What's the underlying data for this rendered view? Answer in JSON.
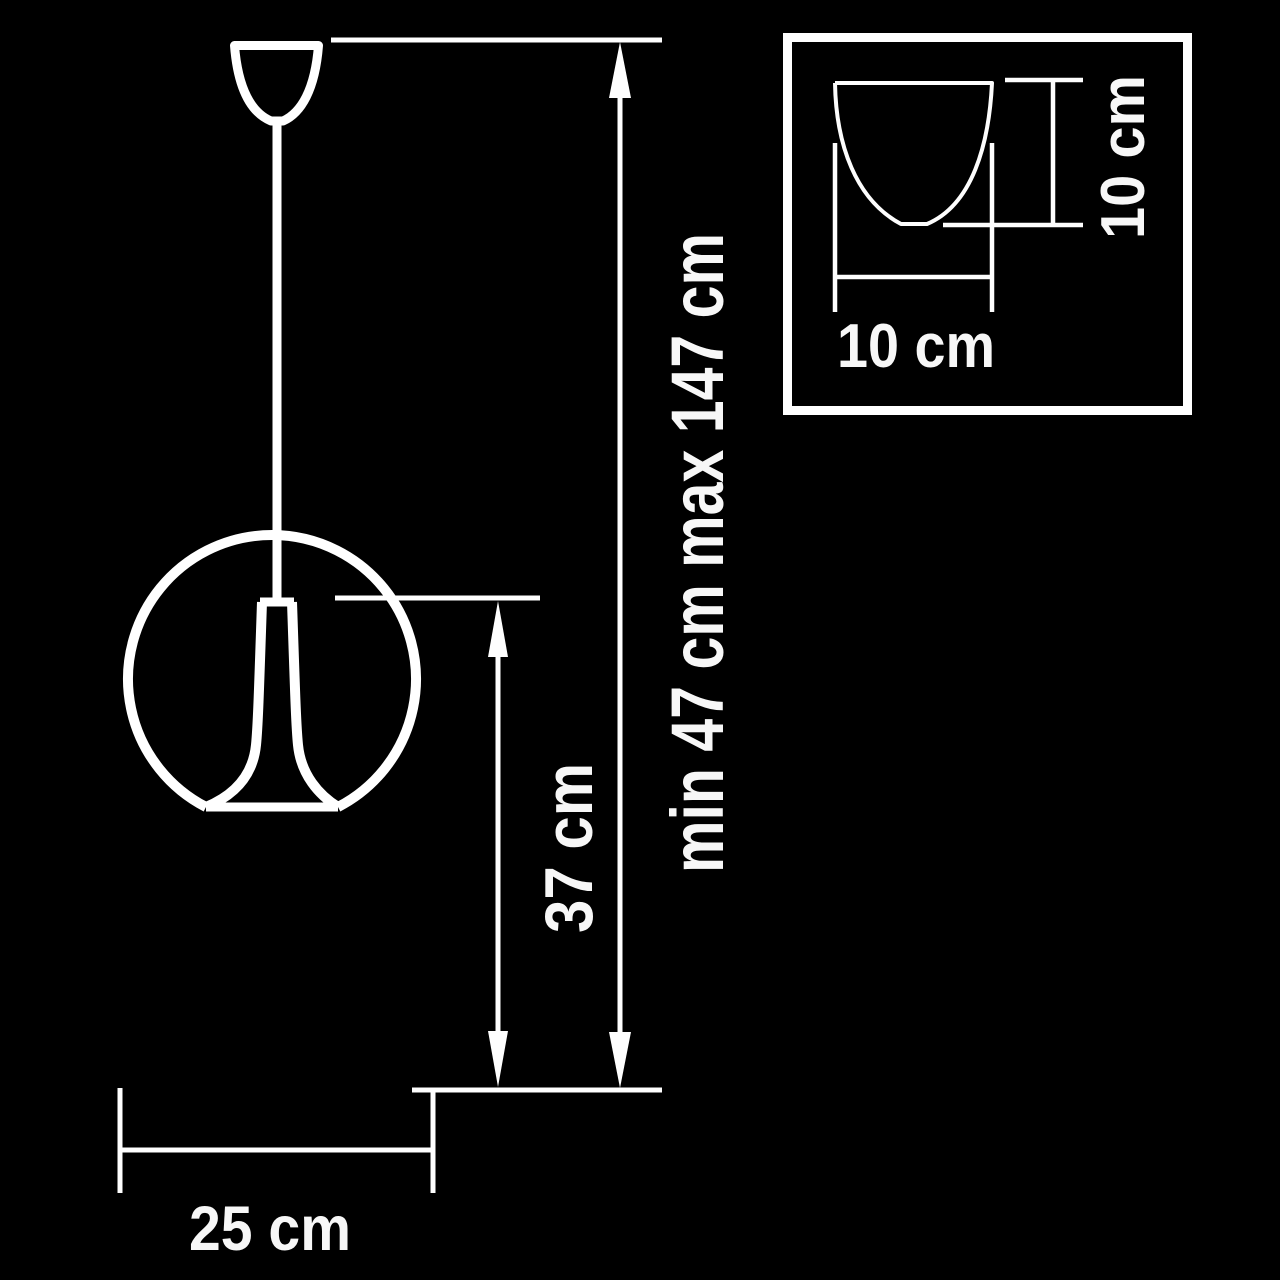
{
  "diagram": {
    "title": "pendant-lamp-dimension-drawing",
    "background_color": "#000000",
    "line_color": "#ffffff",
    "labels": {
      "suspension_height": "min 47 cm max 147 cm",
      "fixture_height": "37 cm",
      "shade_diameter": "25 cm",
      "canopy_width": "10 cm",
      "canopy_height": "10 cm"
    },
    "dimensions_cm": {
      "shade_diameter": 25,
      "fixture_height": 37,
      "suspension_min": 47,
      "suspension_max": 147,
      "canopy_width": 10,
      "canopy_height": 10
    }
  }
}
